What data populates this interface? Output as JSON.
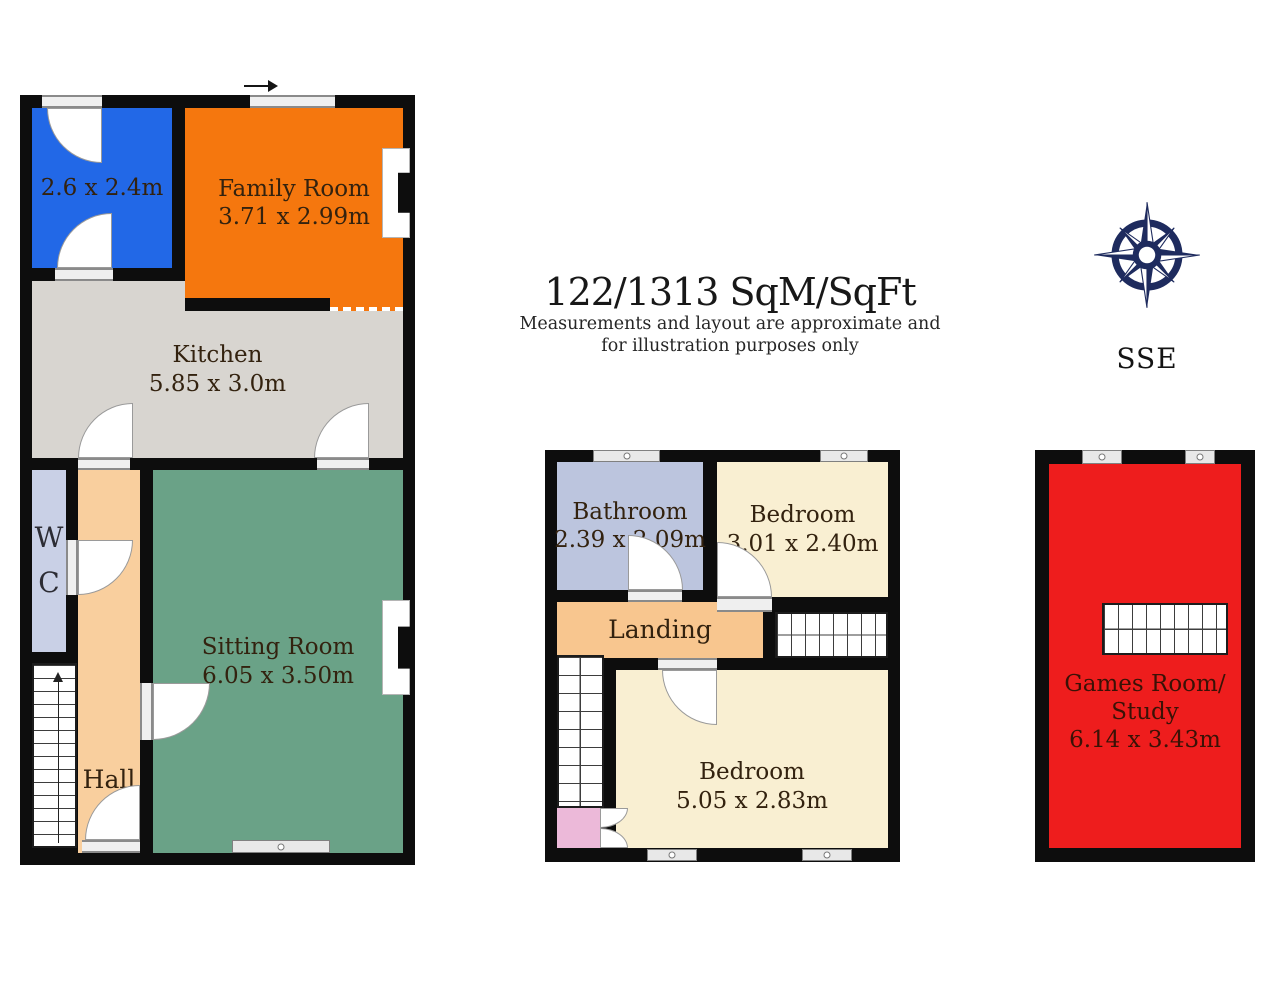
{
  "page": {
    "background": "#ffffff",
    "wall_color": "#0d0d0d"
  },
  "summary": {
    "area": "122/1313 SqM/SqFt",
    "disclaimer_line1": "Measurements and layout are approximate and",
    "disclaimer_line2": "for illustration purposes only"
  },
  "compass": {
    "direction_label": "SSE",
    "icon": "compass-rose",
    "color": "#1e2b5e"
  },
  "ground_floor": {
    "store_room": {
      "dims": "2.6 x 2.4m",
      "color": "#2268e7"
    },
    "family_room": {
      "name": "Family Room",
      "dims": "3.71 x 2.99m",
      "color": "#f5770e"
    },
    "kitchen": {
      "name": "Kitchen",
      "dims": "5.85 x 3.0m",
      "color": "#d8d5d0"
    },
    "wc": {
      "letter_top": "W",
      "letter_bottom": "C",
      "color": "#c9d0e6"
    },
    "hall": {
      "name": "Hall",
      "color": "#f9cf9e"
    },
    "sitting_room": {
      "name": "Sitting Room",
      "dims": "6.05 x 3.50m",
      "color": "#6aa287"
    }
  },
  "first_floor": {
    "bathroom": {
      "name": "Bathroom",
      "dims": "2.39 x 2.09m",
      "color": "#bcc5de"
    },
    "bedroom_front": {
      "name": "Bedroom",
      "dims": "3.01 x 2.40m",
      "color": "#f9efd2"
    },
    "landing": {
      "name": "Landing",
      "color": "#f8c68f"
    },
    "bedroom_main": {
      "name": "Bedroom",
      "dims": "5.05 x 2.83m",
      "color": "#f9efd2"
    },
    "closet_color": "#ecb9d9"
  },
  "top_floor": {
    "games_room": {
      "name_line1": "Games Room/",
      "name_line2": "Study",
      "dims": "6.14 x 3.43m",
      "color": "#ee1d1d"
    }
  }
}
